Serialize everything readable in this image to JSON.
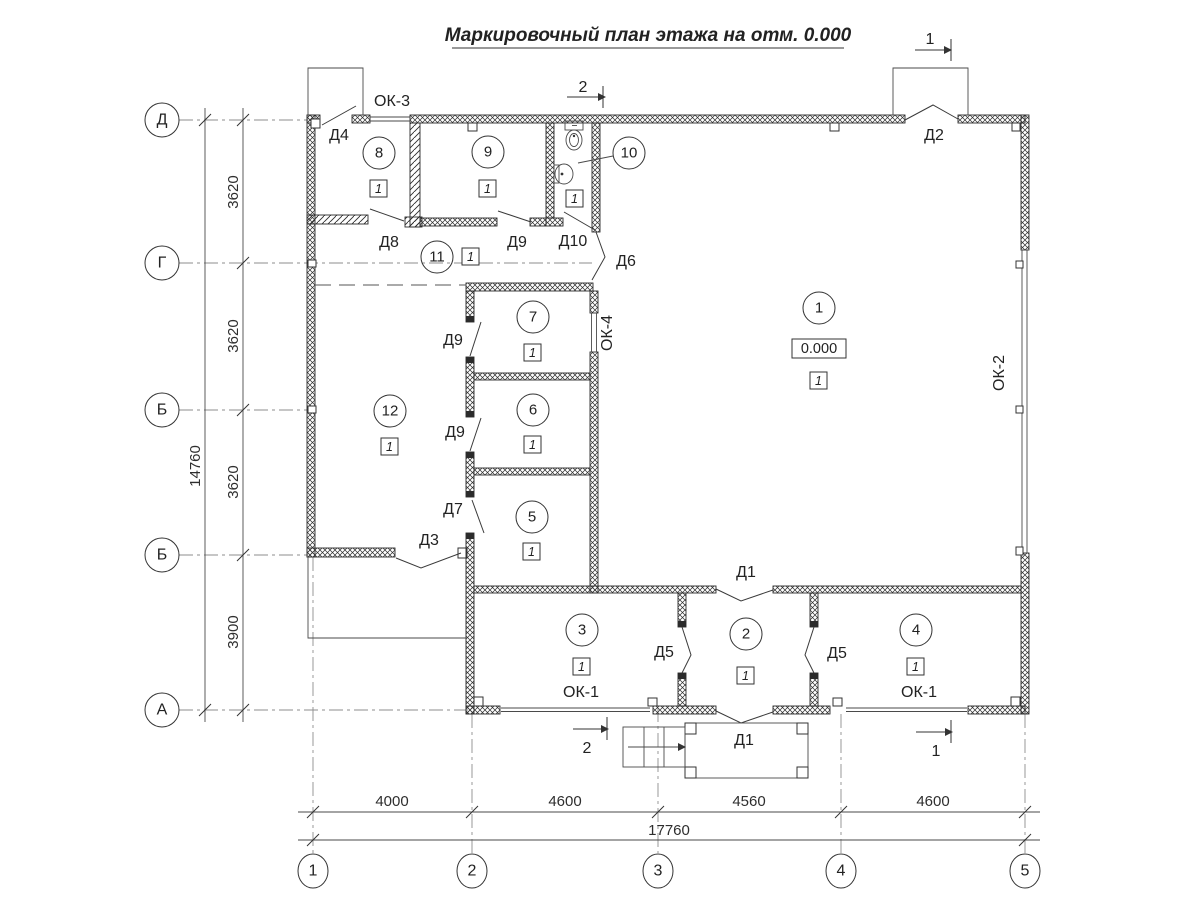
{
  "title": "Маркировочный план этажа на отм. 0.000",
  "axes": {
    "left": [
      "Д",
      "Г",
      "Б",
      "Б",
      "А"
    ],
    "bottom": [
      "1",
      "2",
      "3",
      "4",
      "5"
    ]
  },
  "dims": {
    "left_segments": [
      "3620",
      "3620",
      "3620",
      "3900"
    ],
    "left_total": "14760",
    "bottom_segments": [
      "4000",
      "4600",
      "4560",
      "4600"
    ],
    "bottom_total": "17760"
  },
  "rooms": [
    {
      "num": "1",
      "floor": "1",
      "elevation": "0.000"
    },
    {
      "num": "2",
      "floor": "1"
    },
    {
      "num": "3",
      "floor": "1"
    },
    {
      "num": "4",
      "floor": "1"
    },
    {
      "num": "5",
      "floor": "1"
    },
    {
      "num": "6",
      "floor": "1"
    },
    {
      "num": "7",
      "floor": "1"
    },
    {
      "num": "8",
      "floor": "1"
    },
    {
      "num": "9",
      "floor": "1"
    },
    {
      "num": "10",
      "floor": "1"
    },
    {
      "num": "11",
      "floor": "1"
    },
    {
      "num": "12",
      "floor": "1"
    }
  ],
  "doors": {
    "d1": "Д1",
    "d2": "Д2",
    "d3": "Д3",
    "d4": "Д4",
    "d5": "Д5",
    "d6": "Д6",
    "d7": "Д7",
    "d8": "Д8",
    "d9": "Д9",
    "d10": "Д10"
  },
  "windows": {
    "ok1": "ОК-1",
    "ok2": "ОК-2",
    "ok3": "ОК-3",
    "ok4": "ОК-4"
  },
  "sections": {
    "s1": "1",
    "s2": "2"
  },
  "colors": {
    "line": "#333333",
    "wall": "#2b2b2b",
    "grid": "#8d8d8d",
    "bg": "#ffffff"
  }
}
